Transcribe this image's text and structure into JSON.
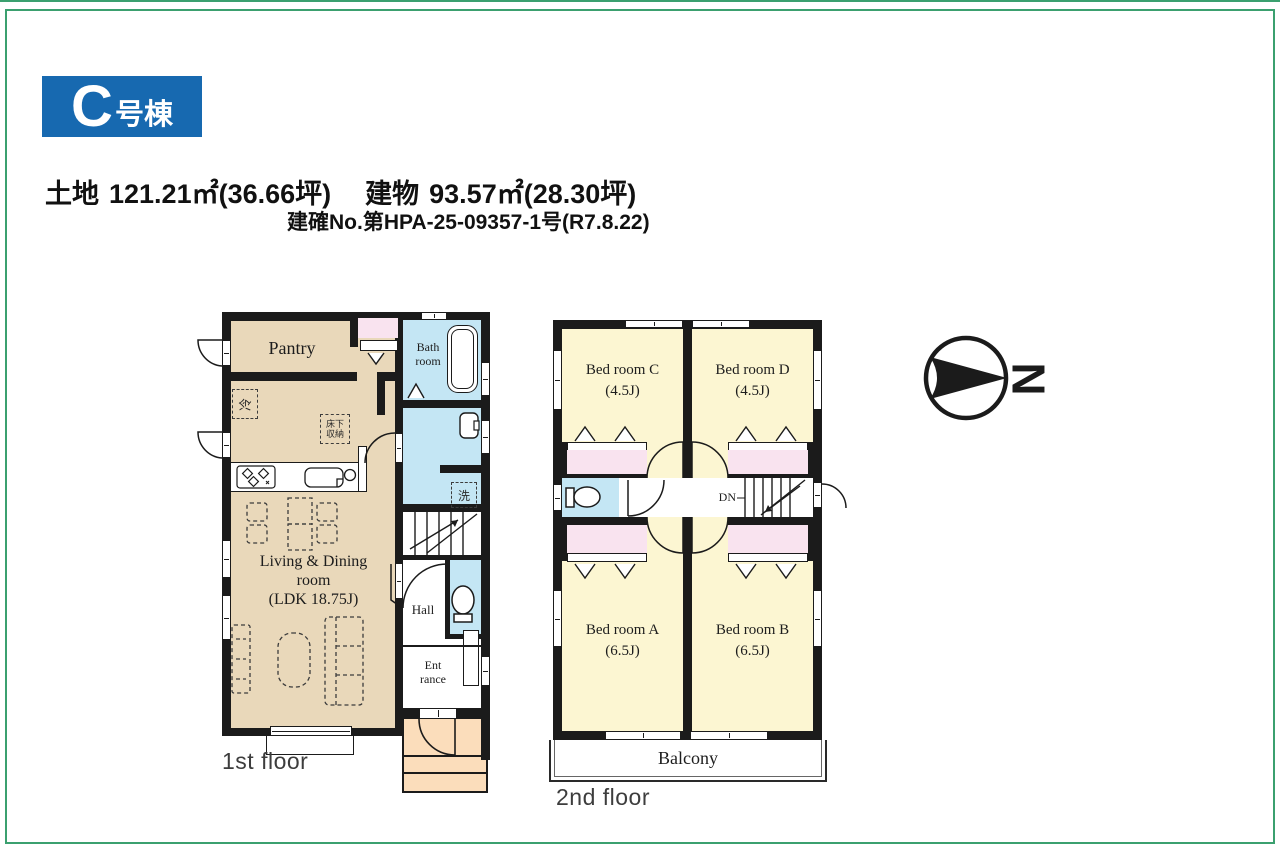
{
  "header": {
    "badge_letter": "C",
    "badge_suffix": "号棟",
    "land_label": "土地",
    "land_value": "121.21㎡(36.66坪)",
    "building_label": "建物",
    "building_value": "93.57㎡(28.30坪)",
    "permit": "建確No.第HPA-25-09357-1号(R7.8.22)"
  },
  "floor1": {
    "caption": "1st floor",
    "pantry": "Pantry",
    "fridge": "冷",
    "floor_storage": "床下\n収納",
    "bath": "Bath\nroom",
    "washer": "洗",
    "ldk": "Living & Dining\nroom\n(LDK 18.75J)",
    "hall": "Hall",
    "entrance": "Ent\nrance"
  },
  "floor2": {
    "caption": "2nd floor",
    "bedroom_c": "Bed room C\n(4.5J)",
    "bedroom_d": "Bed room D\n(4.5J)",
    "bedroom_a": "Bed room A\n(6.5J)",
    "bedroom_b": "Bed room B\n(6.5J)",
    "down": "DN",
    "balcony": "Balcony"
  },
  "compass": {
    "north": "N"
  },
  "colors": {
    "border_green": "#3ba06f",
    "badge_blue": "#1769b0",
    "wall": "#1b1b1b",
    "floor_tan": "#e9d8ba",
    "room_yellow": "#fcf6d2",
    "closet_pink": "#f9e3ef",
    "wet_blue": "#c4e6f4",
    "porch_peach": "#fbddbb"
  }
}
